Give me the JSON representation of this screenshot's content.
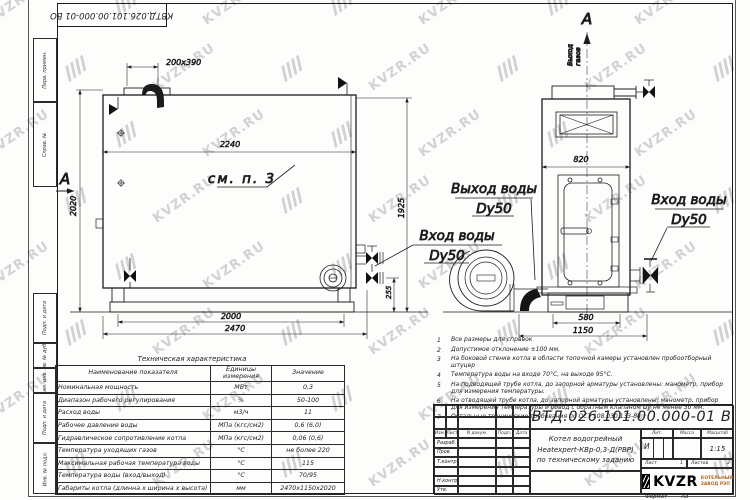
{
  "watermark_text": "KVZR.RU",
  "stamp_top": "КВТД.026.101.00.000-01 ВО",
  "frame_sidebar": {
    "top_labels": [
      "Перв. примен.",
      "Справ. №"
    ],
    "bottom_labels": [
      "Подп. и дата",
      "Инв. № дубл.",
      "Взам. инв. №",
      "Подп. и дата",
      "Инв. № подл."
    ]
  },
  "main_view": {
    "section_label": "А",
    "callout": "см. п. 3",
    "dim_chimney": "200х390",
    "dim_width_inner": "2240",
    "dim_height_left": "2020",
    "dim_height_right": "1925",
    "dim_base": "2000",
    "dim_overall": "2470",
    "dim_inlet_height": "255",
    "water_inlet_label": "Вход воды",
    "water_inlet_dn": "Dy50"
  },
  "front_view": {
    "view_label": "А",
    "gas_outlet_line1": "Выход",
    "gas_outlet_line2": "газов",
    "dim_width": "820",
    "dim_base": "580",
    "dim_overall": "1150",
    "water_outlet_label": "Выход воды",
    "water_outlet_dn": "Dy50",
    "water_inlet_label": "Вход воды",
    "water_inlet_dn": "Dy50"
  },
  "notes": [
    {
      "num": "1",
      "text": "Все размеры для справок"
    },
    {
      "num": "2",
      "text": "Допустимое отклонение ±100 мм."
    },
    {
      "num": "3",
      "text": "На боковой стенке котла в области топочной камеры установлен пробоотборный штуцер"
    },
    {
      "num": "4",
      "text": "Температура воды на входе 70°С, на выходе 95°С."
    },
    {
      "num": "5",
      "text": "На подводящей трубе котла, до запорной арматуры установлены: манометр, прибор для измерения температуры."
    },
    {
      "num": "6",
      "text": "На отводящей трубе котла, до запорной арматуры установлены: манометр, прибор для измерения температуры и обвод с обратным клапаном Dу не менее 50 мм."
    },
    {
      "num": "7",
      "text": "Остальные технические требования по ОСТ 108.030.133-84."
    }
  ],
  "tech_table": {
    "title": "Техническая характеристика",
    "col_headers": [
      "Наименование показателя",
      "Единицы измерения",
      "Значение"
    ],
    "rows": [
      [
        "Номинальная мощность",
        "МВт",
        "0,3"
      ],
      [
        "Диапазон рабочего регулирования",
        "%",
        "50-100"
      ],
      [
        "Расход воды",
        "м3/ч",
        "11"
      ],
      [
        "Рабочее давление воды",
        "МПа (кгс/см2)",
        "0,6 (6,0)"
      ],
      [
        "Гидравлическое сопротивление котла",
        "МПа (кгс/см2)",
        "0,06 (0,6)"
      ],
      [
        "Температура уходящих газов",
        "°С",
        "не более 220"
      ],
      [
        "Максимальная рабочая температура воды",
        "°С",
        "115"
      ],
      [
        "Температура воды (вход/выход)",
        "°С",
        "70/95"
      ],
      [
        "Габариты котла (длинна х ширина х высота)",
        "мм",
        "2470х1150х2020"
      ]
    ]
  },
  "title_block": {
    "doc_number": "КВТД.026.101.00.000-01 ВО",
    "change_header": [
      "Изм.",
      "Лист",
      "N докум.",
      "Подп.",
      "Дата"
    ],
    "sign_labels": [
      "Разраб.",
      "Пров.",
      "Т.контр.",
      "",
      "Н.контр.",
      "Утв."
    ],
    "product_lines": [
      "Котел водогрейный",
      "Heatexpert-КВр-0,3-Д(РВР)",
      "по техническому заданию"
    ],
    "lit_label": "Лит.",
    "lit_value": "И",
    "mass_label": "Масса",
    "scale_label": "Масштаб",
    "scale_value": "1:15",
    "sheet_label": "Лист",
    "sheet_value": "1",
    "sheets_label": "Листов",
    "sheets_value": "2",
    "brand": "KVZR",
    "brand_sub1": "КОТЕЛЬНЫЙ",
    "brand_sub2": "ЗАВОД РЭП",
    "format_label": "Формат",
    "format_value": "А3"
  }
}
